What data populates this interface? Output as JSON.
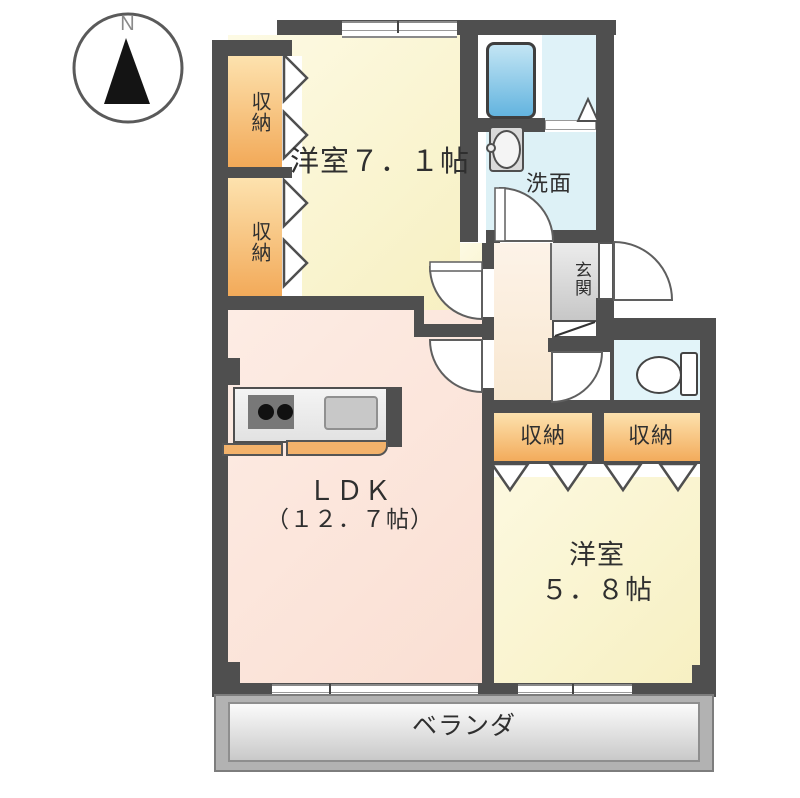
{
  "compass": {
    "north_label": "N"
  },
  "labels": {
    "bedroom1": "洋室７．１帖",
    "bedroom2_line1": "洋室",
    "bedroom2_line2": "５．８帖",
    "ldk_line1": "ＬＤＫ",
    "ldk_line2": "（１２．７帖）",
    "washroom": "洗面",
    "entrance": "玄関",
    "storage": "収納",
    "balcony": "ベランダ"
  },
  "fixtures": [
    "compass-north-arrow",
    "bathtub",
    "wash-basin",
    "toilet",
    "kitchen-stove",
    "kitchen-sink",
    "kitchen-counter",
    "door-swing-arc-x5",
    "folding-closet-doors",
    "sliding-windows-x3",
    "entrance-step"
  ],
  "colors": {
    "wall": "#4f4f4f",
    "bedroom_fill": "#faf5d2",
    "ldk_fill": "#fce5db",
    "corridor_fill": "#fbeedd",
    "storage_fill_top": "#fde2ae",
    "storage_fill_bottom": "#f2a958",
    "bathroom_fill": "#dff2f8",
    "bathtub_top": "#c3e5f4",
    "bathtub_bottom": "#63b4df",
    "entrance_fill": "#d9d9d9",
    "balcony_fill": "#b2b2b2",
    "kitchen_ledge": "#f3b26b"
  }
}
